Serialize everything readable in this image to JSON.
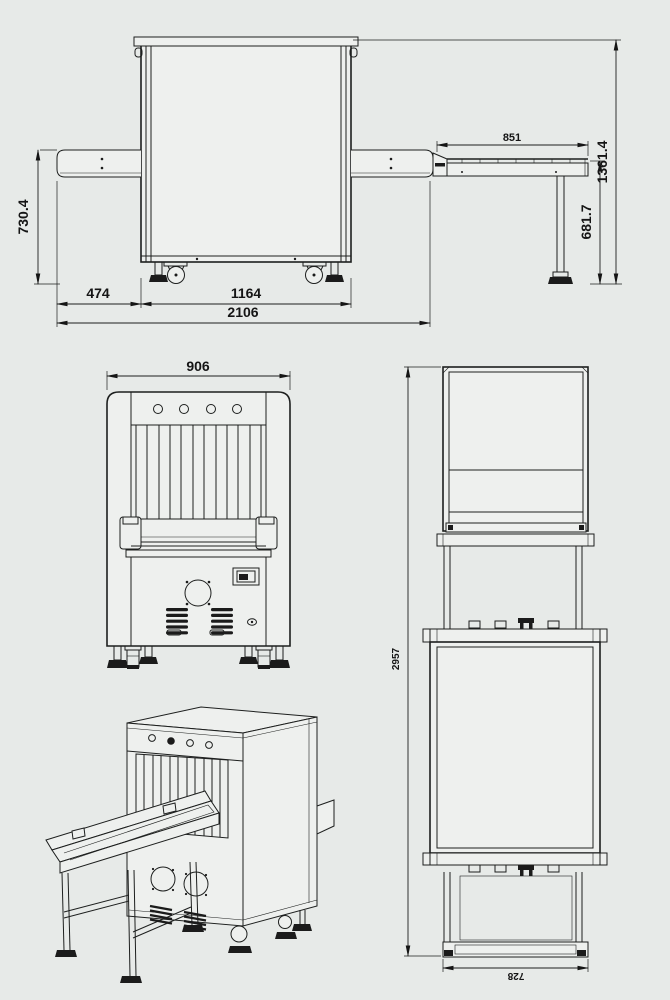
{
  "colors": {
    "background": "#e7eae8",
    "line": "#1d1f1e",
    "dark_detail": "#1b1b1b"
  },
  "views": {
    "side_elevation": {
      "dimensions": {
        "conveyor_height": "730.4",
        "entry_conveyor_length": "474",
        "cabinet_length": "1164",
        "overall_length": "2106",
        "exit_table_length": "851",
        "overall_height": "1361.4",
        "table_height": "681.7"
      }
    },
    "front_elevation": {
      "dimensions": {
        "overall_width": "906"
      }
    },
    "plan_view": {
      "dimensions": {
        "overall_length": "2957",
        "table_width": "728"
      }
    },
    "isometric_view": {}
  }
}
